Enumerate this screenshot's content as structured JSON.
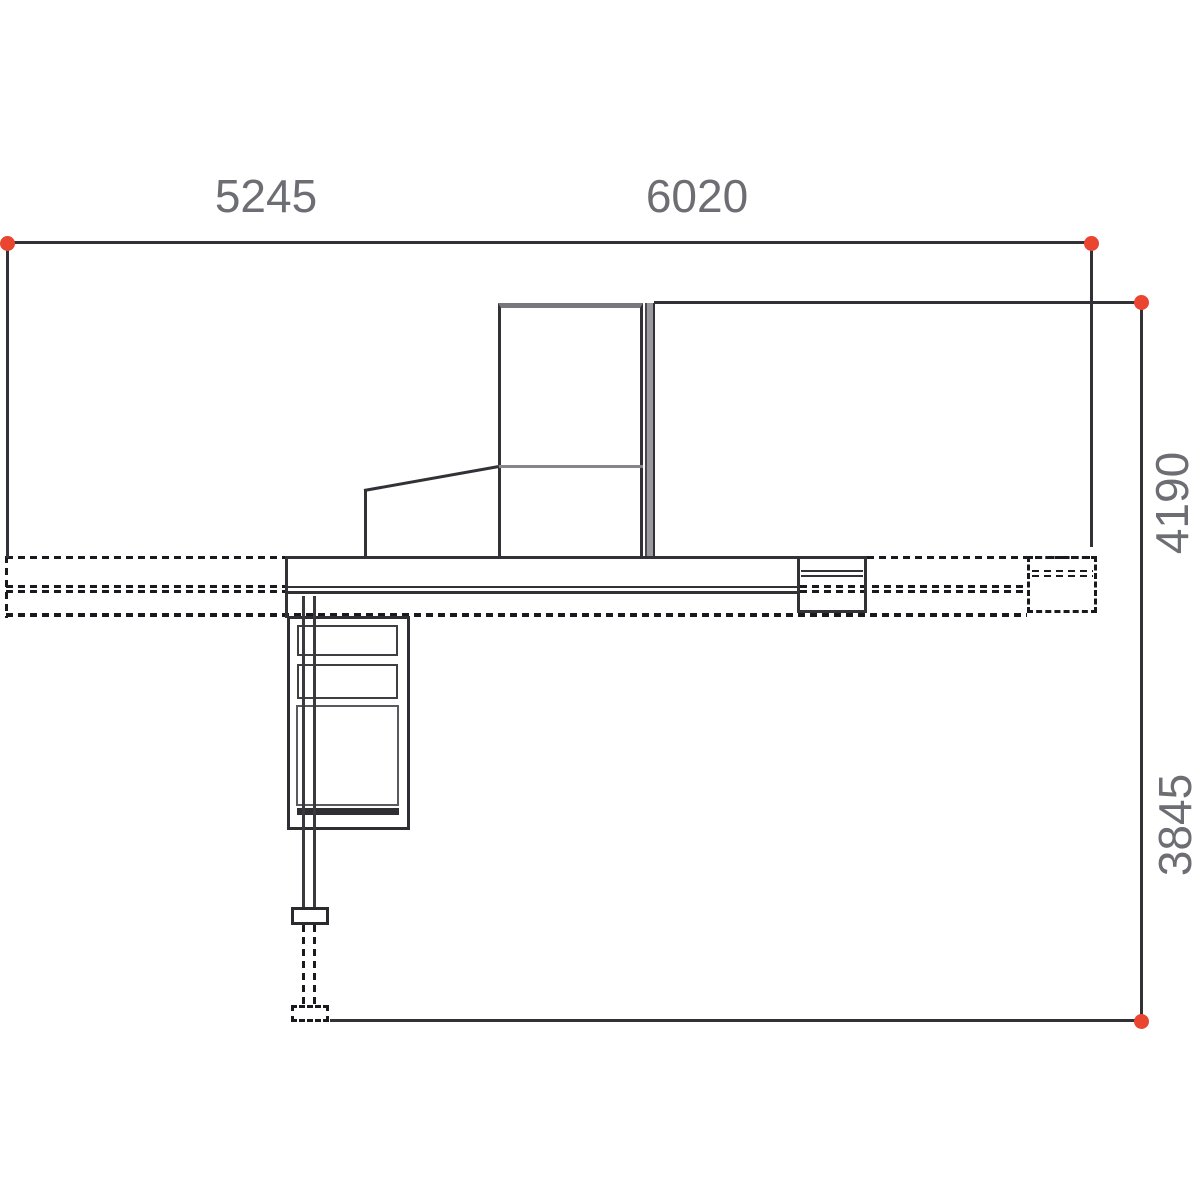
{
  "drawing": {
    "dimensions": {
      "top_left": "5245",
      "top_right": "6020",
      "right_upper": "4190",
      "right_lower": "3845"
    },
    "colors": {
      "solid_line": "#323236",
      "grey_line": "#85858a",
      "dashed_line": "#1a1a1e",
      "label_text": "#6d6d74",
      "endpoint_marker": "#e94530"
    }
  }
}
